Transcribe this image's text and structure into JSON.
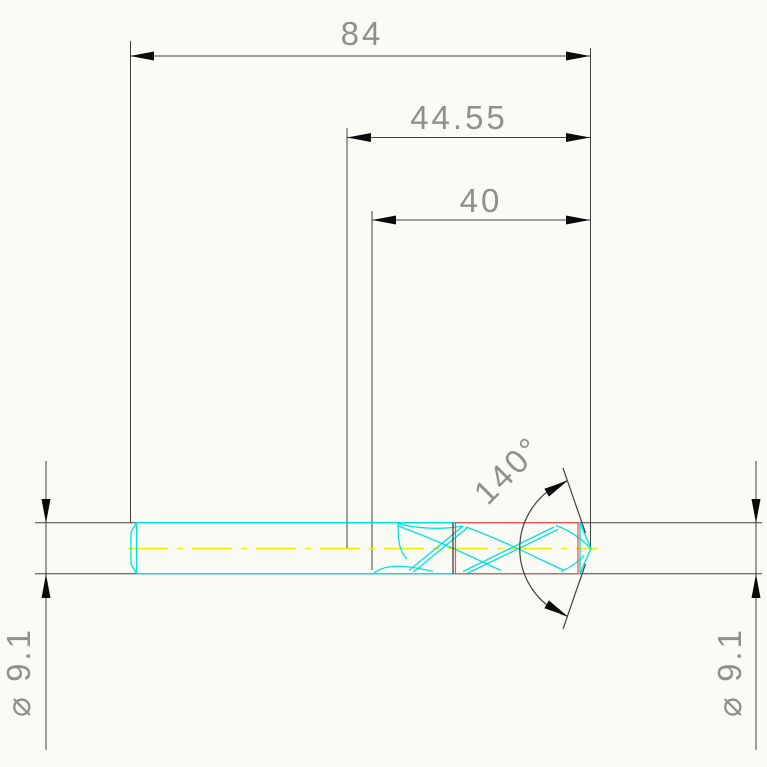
{
  "drawing": {
    "dimensions": {
      "overall_length": "84",
      "shank_to_point": "44.55",
      "flute_length": "40",
      "point_angle": "140°",
      "diameter_left": "⌀ 9.1",
      "diameter_right": "⌀ 9.1"
    },
    "colors": {
      "background": "#fbfbf6",
      "dimension_line": "#404040",
      "arrow": "#0a0a0a",
      "text": "#8f8f8f",
      "outline_cyan": "#00e0e0",
      "highlight_red": "#ff4a4a",
      "centerline_yellow": "#f0ee00"
    }
  }
}
